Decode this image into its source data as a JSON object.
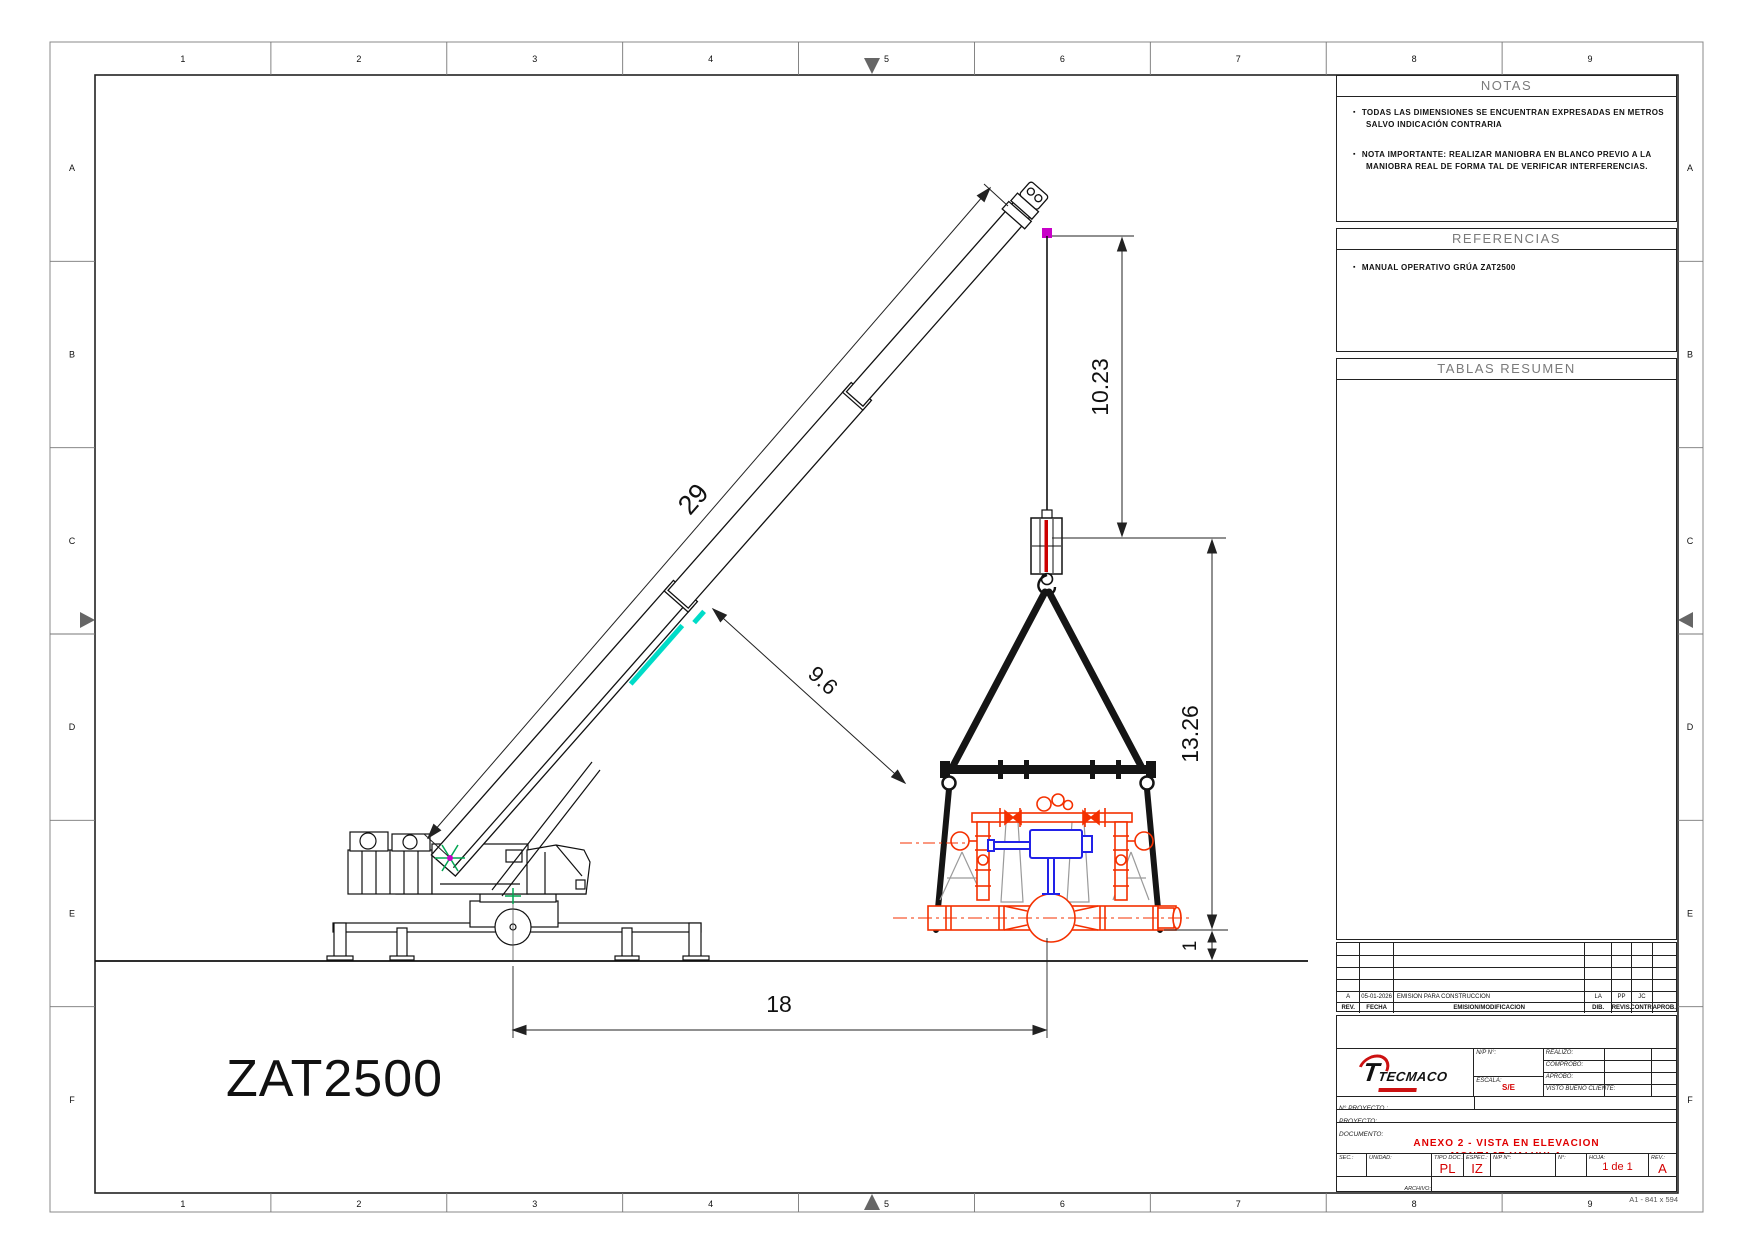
{
  "sheet": {
    "grid_columns": [
      "1",
      "2",
      "3",
      "4",
      "5",
      "6",
      "7",
      "8",
      "9"
    ],
    "grid_rows": [
      "A",
      "B",
      "C",
      "D",
      "E",
      "F"
    ],
    "format_label": "A1 - 841 x 594"
  },
  "notes": {
    "title": "NOTAS",
    "item1_line1": "TODAS LAS DIMENSIONES SE ENCUENTRAN EXPRESADAS EN METROS",
    "item1_line2": "SALVO INDICACIÓN CONTRARIA",
    "item2_line1": "NOTA IMPORTANTE: REALIZAR MANIOBRA EN BLANCO PREVIO A LA",
    "item2_line2": "MANIOBRA REAL DE FORMA TAL DE VERIFICAR INTERFERENCIAS."
  },
  "references": {
    "title": "REFERENCIAS",
    "item1": "MANUAL OPERATIVO GRÚA ZAT2500"
  },
  "tables": {
    "title": "TABLAS RESUMEN"
  },
  "revision": {
    "headers": [
      "REV.",
      "FECHA",
      "EMISION/MODIFICACION",
      "DIB.",
      "REVIS.",
      "CONTR.",
      "APROB."
    ],
    "row": [
      "A",
      "05-01-2026",
      "EMISION PARA CONSTRUCCION",
      "LA",
      "PP",
      "JC",
      ""
    ]
  },
  "title_block": {
    "company": "TECMACO",
    "np_label": "N/P N°:",
    "escala_label": "ESCALA:",
    "escala_value": "S/E",
    "sign_labels": [
      "REALIZÓ:",
      "COMPROBÓ:",
      "APROBÓ:",
      "VISTO BUENO CLIENTE:"
    ],
    "nproyecto_label": "N° PROYECTO :",
    "proyecto_label": "PROYECTO:",
    "documento_label": "DOCUMENTO:",
    "doc_title_line1": "ANEXO 2 - VISTA EN ELEVACION",
    "doc_title_line2": "MONTAJE VALVULA",
    "sec_label": "SEC.:",
    "unidad_label": "UNIDAD:",
    "tipodoc_label": "TIPO DOC.:",
    "tipodoc_value": "PL",
    "espec_label": "ESPEC.:",
    "espec_value": "IZ",
    "np2_label": "N/P N°:",
    "num_label": "N°:",
    "hoja_label": "HOJA:",
    "hoja_value": "1 de 1",
    "rev_label": "REV.:",
    "rev_value": "A",
    "archivo_label": "ARCHIVO:"
  },
  "drawing": {
    "crane_model": "ZAT2500",
    "dim_boom": "29",
    "dim_boom_to_load": "9.6",
    "dim_head_to_hook": "10.23",
    "dim_hook_to_pipe": "13.26",
    "dim_radius": "18",
    "dim_clearance": "1",
    "colors": {
      "valve_red": "#f43000",
      "actuator_blue": "#2222e8",
      "marker_cyan": "#00dcc8",
      "marker_green": "#00a651",
      "marker_magenta": "#c800c8",
      "accent_red": "#d40000"
    }
  }
}
